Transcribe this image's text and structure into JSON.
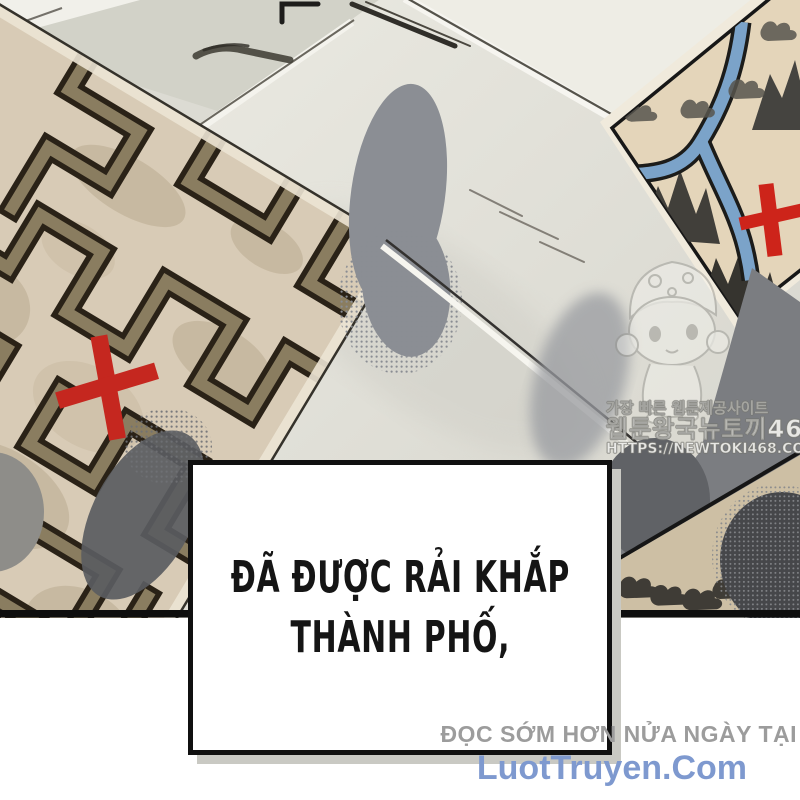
{
  "page": {
    "background": "#ffffff"
  },
  "panel": {
    "floor_color": "#e3e2da",
    "sheet_light_color": "#eeede5",
    "sheet_dark_color": "#d2d2c8",
    "ink_blob_color": "#8a8d93",
    "panel_border_color": "#0e0e0e"
  },
  "maze_map": {
    "paper_color": "#d8cbb6",
    "wall_fill_color": "#8a7d60",
    "wall_outline_color": "#2a2217",
    "x_mark_color": "#c5271f"
  },
  "mountain_map": {
    "paper_color": "#e4d5ba",
    "river_color": "#7ba3c9",
    "mountain_color": "#3f3d38",
    "cross_color": "#cd241a"
  },
  "caption": {
    "lines": [
      "ĐÃ ĐƯỢC RẢI KHẮP",
      "THÀNH PHỐ,"
    ],
    "text_color": "#151515",
    "box_color": "#ffffff",
    "border_color": "#101010"
  },
  "site_watermark": {
    "line1": "가장 빠른 웹툰제공사이트",
    "line2": "웹툰왕국뉴토끼468",
    "line3": "HTTPS://NEWTOKI468.COM"
  },
  "promo_watermark": {
    "tagline": "ĐỌC SỚM HƠN NỬA NGÀY TẠI",
    "site_name": "LuotTruyen.Com",
    "tagline_color": "#9c9c9c",
    "site_color": "#7e99cf"
  }
}
